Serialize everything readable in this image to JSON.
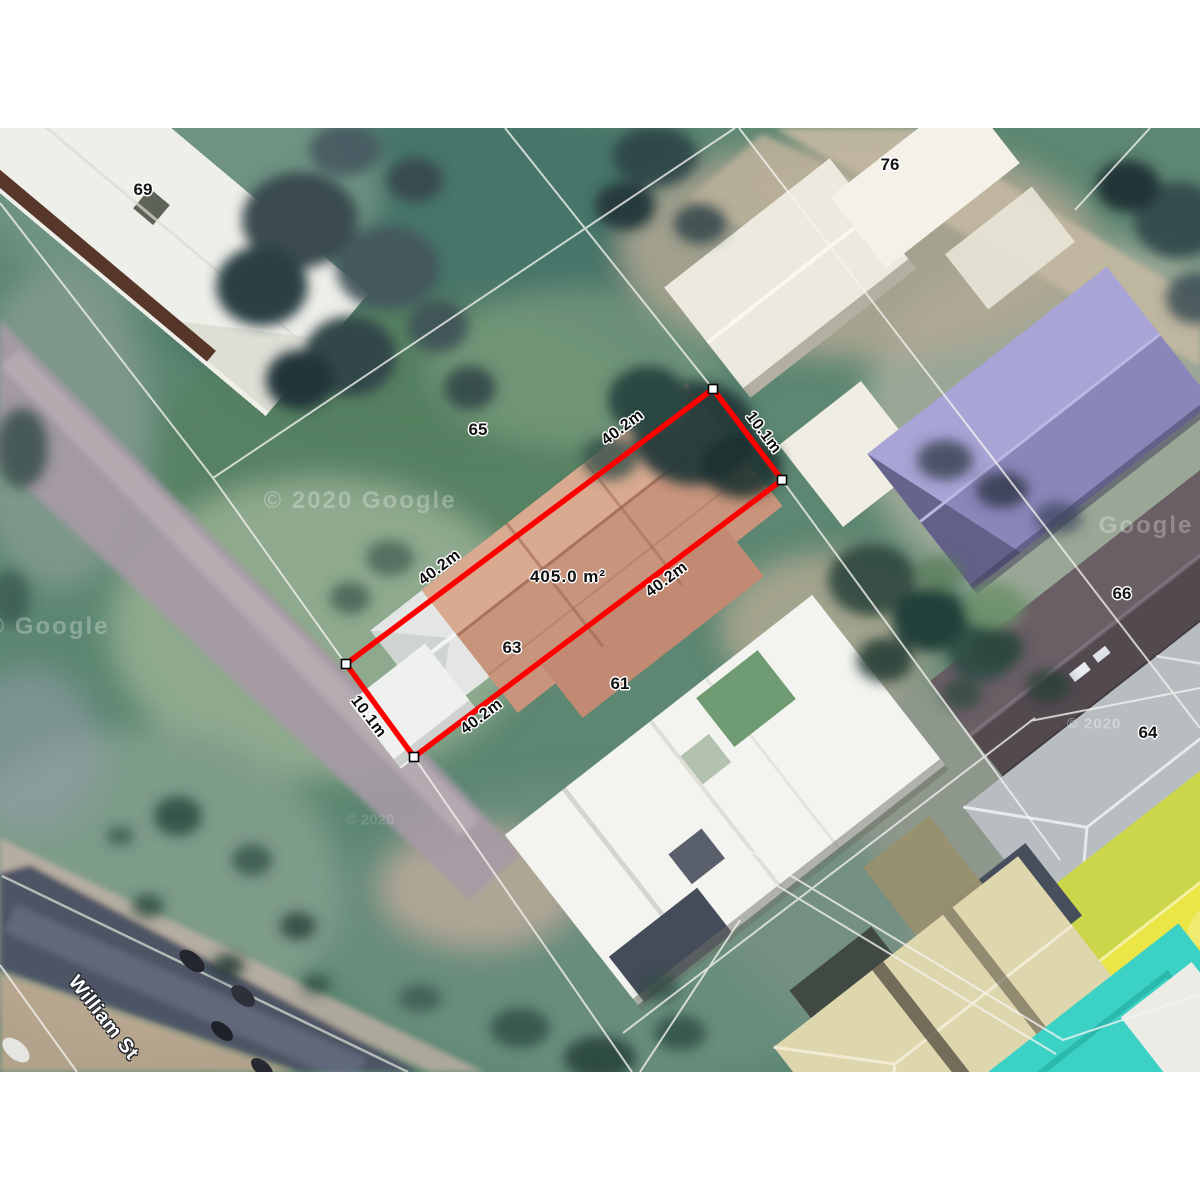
{
  "map": {
    "street_label": {
      "text": "William St",
      "x": 103,
      "y": 1018,
      "rotation": 52
    },
    "lot_numbers": [
      {
        "text": "69",
        "x": 143,
        "y": 190
      },
      {
        "text": "76",
        "x": 890,
        "y": 165
      },
      {
        "text": "65",
        "x": 478,
        "y": 430
      },
      {
        "text": "63",
        "x": 512,
        "y": 648
      },
      {
        "text": "61",
        "x": 620,
        "y": 684
      },
      {
        "text": "66",
        "x": 1122,
        "y": 594
      },
      {
        "text": "64",
        "x": 1148,
        "y": 733
      }
    ],
    "selected_parcel": {
      "area_label": {
        "text": "405.0 m²",
        "x": 568,
        "y": 577
      },
      "outline_color": "#fe0000",
      "vertex_fill": "#ffffff",
      "vertex_stroke": "#000000",
      "vertices": [
        [
          713,
          389
        ],
        [
          782,
          480
        ],
        [
          414,
          757
        ],
        [
          346,
          664
        ]
      ],
      "dimension_labels": [
        {
          "text": "40.2m",
          "x": 623,
          "y": 428,
          "rotation": -37
        },
        {
          "text": "10.1m",
          "x": 763,
          "y": 433,
          "rotation": 53
        },
        {
          "text": "40.2m",
          "x": 440,
          "y": 568,
          "rotation": -37
        },
        {
          "text": "40.2m",
          "x": 667,
          "y": 580,
          "rotation": -37
        },
        {
          "text": "40.2m",
          "x": 482,
          "y": 717,
          "rotation": -37
        },
        {
          "text": "10.1m",
          "x": 368,
          "y": 717,
          "rotation": 53
        }
      ]
    },
    "provider_watermarks": [
      {
        "text": "© 2020 Google",
        "x": 360,
        "y": 501,
        "style": "lg"
      },
      {
        "text": "© Google",
        "x": 48,
        "y": 627,
        "style": "lg"
      },
      {
        "text": "Google",
        "x": 1146,
        "y": 526,
        "style": "lg"
      },
      {
        "text": "© 2020",
        "x": 1094,
        "y": 724,
        "style": "sm"
      },
      {
        "text": "© 2020",
        "x": 370,
        "y": 820,
        "style": "xf"
      }
    ]
  }
}
